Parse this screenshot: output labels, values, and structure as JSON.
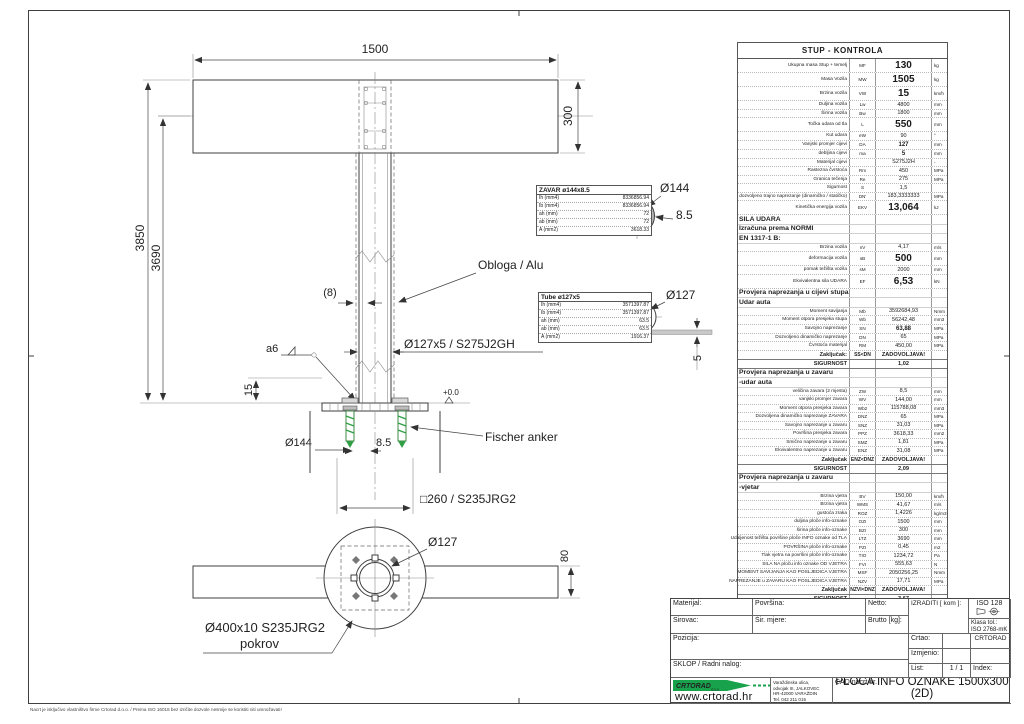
{
  "frame": {
    "disclaimer": "Nacrt  je isključivo vlastništvo firme Crtorad d.o.o. / Prema ISO 16016 bez izričite dozvole nesmije se koristiti niti umnožavati!"
  },
  "drawing": {
    "dim_plate_width": "1500",
    "dim_plate_height": "300",
    "dim_height_total": "3850",
    "dim_height_plate_center": "3690",
    "dim_wall_gap": "(8)",
    "label_cladding": "Obloga / Alu",
    "label_pipe_spec": "Ø127x5 / S275J2GH",
    "label_weld": "a6",
    "dim_plate_offset": "15",
    "dim_level": "+0.0",
    "dim_base_dia": "Ø144",
    "dim_base_weld": "8.5",
    "label_anchor": "Fischer anker",
    "label_base_plate": "□260 / S235JRG2",
    "label_pole_dia_bottom": "Ø127",
    "dim_sign_depth": "80",
    "label_cover_line1": "Ø400x10 S235JRG2",
    "label_cover_line2": "pokrov",
    "detail_weld_dia": "Ø144",
    "detail_weld_size": "8.5",
    "detail_tube_dia": "Ø127",
    "detail_sheet_thickness": "5"
  },
  "zavar_box": {
    "title": "ZAVAR ø144x8.5",
    "rows": [
      [
        "Ih (mm4)",
        "8336856.94"
      ],
      [
        "Ib (mm4)",
        "8336856.94"
      ],
      [
        "ah (mm)",
        "72"
      ],
      [
        "ab (mm)",
        "72"
      ],
      [
        "A (mm2)",
        "3618.33"
      ]
    ]
  },
  "tube_box": {
    "title": "Tube ø127x5",
    "rows": [
      [
        "Ih (mm4)",
        "3571397.87"
      ],
      [
        "Ib (mm4)",
        "3571397.87"
      ],
      [
        "ah (mm)",
        "63.5"
      ],
      [
        "ab (mm)",
        "63.5"
      ],
      [
        "A (mm2)",
        "1916.37"
      ]
    ]
  },
  "kontrola": {
    "title": "STUP - KONTROLA",
    "rows": [
      [
        "Ukupna masa Stup + temelj",
        "MF",
        "130",
        "kg",
        "b"
      ],
      [
        "Masa Vozila",
        "MW",
        "1505",
        "kg",
        "b"
      ],
      [
        "Brzina vozila",
        "VW",
        "15",
        "km/h",
        "b"
      ],
      [
        "Duljina vozila",
        "Lw",
        "4800",
        "mm",
        "n"
      ],
      [
        "Širina vozila",
        "Bw",
        "1800",
        "mm",
        "n"
      ],
      [
        "Točka udara od tla",
        "L",
        "550",
        "mm",
        "b"
      ],
      [
        "Kut udara",
        "eW",
        "90",
        "°",
        "n"
      ],
      [
        "Vanjski promjer cijevi",
        "DA",
        "127",
        "mm",
        "m"
      ],
      [
        "debljina cijevi",
        "ma",
        "5",
        "mm",
        "m"
      ],
      [
        "Materijal cijevi",
        "",
        "S275J2H",
        "-",
        "n"
      ],
      [
        "Rastezna čvrstoća",
        "Rm",
        "450",
        "MPa",
        "n"
      ],
      [
        "Granica tečenja",
        "Re",
        "275",
        "MPa",
        "n"
      ],
      [
        "Sigurnost",
        "S",
        "1,5",
        "",
        "n"
      ],
      [
        "dozvoljeno trajno naprezanje (dinamičko / statičko)",
        "DN'",
        "183,3333333",
        "MPa",
        "n"
      ],
      [
        "Kinetička energija vozila",
        "EKV",
        "13,064",
        "kJ",
        "b"
      ],
      [
        "SILA UDARA",
        "",
        "",
        "",
        "s"
      ],
      [
        "Izračuna prema NORMI",
        "",
        "",
        "",
        "s"
      ],
      [
        "EN 1317-1 B:",
        "",
        "",
        "",
        "s"
      ],
      [
        "Brzina vozila",
        "nV",
        "4,17",
        "m/s",
        "n"
      ],
      [
        "deformacija vozila",
        "sB",
        "500",
        "mm",
        "b"
      ],
      [
        "pomak težišta vozila",
        "sM",
        "2000",
        "mm",
        "n"
      ],
      [
        "Ekvivalentna sila UDARA",
        "EF",
        "6,53",
        "kN",
        "b"
      ],
      [
        "Provjera naprezanja u cijevi stupa",
        "",
        "",
        "",
        "s"
      ],
      [
        "Udar auta",
        "",
        "",
        "",
        "s"
      ],
      [
        "Moment savijanja",
        "Mb",
        "3592684,93",
        "Nmm",
        "n"
      ],
      [
        "Moment otpora presjeka stupa",
        "Wb",
        "56242,48",
        "mm3",
        "n"
      ],
      [
        "Savojno naprezanje",
        "SN",
        "63,88",
        "MPa",
        "m"
      ],
      [
        "Dozvoljeno dinamičko naprezanje",
        "DN",
        "65",
        "MPa",
        "n"
      ],
      [
        "Čvrstoća materijal",
        "RM",
        "450,00",
        "MPa",
        "n"
      ],
      [
        "Zaključak:",
        "SS<DN",
        "ZADOVOLJAVA!",
        "",
        "c"
      ],
      [
        "SIGURNOST",
        "",
        "1,02",
        "",
        "g"
      ],
      [
        "Provjera naprezanja u zavaru",
        "",
        "",
        "",
        "s"
      ],
      [
        "-udar auta",
        "",
        "",
        "",
        "s"
      ],
      [
        "veličina zavara   (2 mjesta)",
        "ZW",
        "8,5",
        "mm",
        "n"
      ],
      [
        "vanjski promjer zavara",
        "WV",
        "144,00",
        "mm",
        "n"
      ],
      [
        "Moment otpora presjeka zavara",
        "Wb2",
        "115788,08",
        "mm3",
        "n"
      ],
      [
        "Dozvoljena dinamičko naprezanje ZAVARA",
        "DNZ",
        "65",
        "MPa",
        "n"
      ],
      [
        "Savojno naprezanje u zavaru",
        "SNZ",
        "31,03",
        "MPa",
        "n"
      ],
      [
        "Površina presjeka zavara",
        "PPZ",
        "3618,33",
        "mm2",
        "n"
      ],
      [
        "Smično naprezanje u zavaru",
        "SMZ",
        "1,81",
        "MPa",
        "n"
      ],
      [
        "Ekvivalentno naprezanje u zavaru",
        "ENZ",
        "31,08",
        "MPa",
        "n"
      ],
      [
        "Zaključak",
        "ENZ<DNZ",
        "ZADOVOLJAVA!",
        "",
        "c"
      ],
      [
        "SIGURNOST",
        "",
        "2,09",
        "",
        "g"
      ],
      [
        "Provjera naprezanja u zavaru",
        "",
        "",
        "",
        "s"
      ],
      [
        "-vjetar",
        "",
        "",
        "",
        "s"
      ],
      [
        "Brzina vjetra",
        "BV",
        "150,00",
        "km/h",
        "n"
      ],
      [
        "Brzina vjetra",
        "WMS",
        "41,67",
        "m/s",
        "n"
      ],
      [
        "gustoća zraka",
        "ROZ",
        "1,4226",
        "kg/m3",
        "n"
      ],
      [
        "duljina ploče info-oznake",
        "OZI",
        "1500",
        "mm",
        "n"
      ],
      [
        "širina ploče info-oznake",
        "BZI",
        "300",
        "mm",
        "n"
      ],
      [
        "Udaljenost težišta površine ploče INFO oznake od TLA",
        "LTZ",
        "3690",
        "mm",
        "n"
      ],
      [
        "POVRŠINA ploče info-oznake",
        "PZI",
        "0,45",
        "m2",
        "n"
      ],
      [
        "Tlak vjetra na površini ploče info-oznake",
        "TIO",
        "1234,72",
        "Pa",
        "n"
      ],
      [
        "SILA NA ploču info oznake OD VJETRA",
        "FVI",
        "555,63",
        "N",
        "n"
      ],
      [
        "MOMENT SAVIJANJA KAO POSLJEDICA VJETRA",
        "MSF",
        "2050256,25",
        "Nmm",
        "n"
      ],
      [
        "NAPREZANJE u ZAVARU KAO POSLJEDICA VJETRA",
        "NZV",
        "17,71",
        "MPa",
        "n"
      ],
      [
        "Zaključak",
        "NZVI<DNZ",
        "ZADOVOLJAVA!",
        "",
        "c"
      ],
      [
        "SIGURNOST",
        "",
        "3,67",
        "",
        "g"
      ]
    ]
  },
  "title_block": {
    "materijal_label": "Materijal:",
    "povrsina_label": "Površina:",
    "netto_label": "Netto:",
    "izraditi_label": "IZRADITI [ kom ]:",
    "iso_label": "ISO 128",
    "sirovac_label": "Sirovac:",
    "sir_mjere_label": "Šir. mjere:",
    "brutto_label": "Brutto [kg]:",
    "klasa_label": "Klasa tol.:",
    "klasa_value": "ISO 2768-mK",
    "pozicija_label": "Pozicija:",
    "sklop_label": "SKLOP / Radni nalog:",
    "crtao_label": "Crtao:",
    "crtao_value": "CRTORAD",
    "izmjenio_label": "Izmjenio:",
    "list_label": "List:",
    "list_value": "1  /  1",
    "index_label": "Index:",
    "cad_label": "CAD nacrt br.",
    "drawing_title": "PLOČA INFO OZNAKE 1500x300  (2D)"
  },
  "company": {
    "name": "CRTORAD",
    "suffix": "d.o.o.",
    "website": "www.crtorad.hr",
    "address_lines": [
      "Varaždinska ulica,",
      "odvojak III, JALKOVEC",
      "HR-42000 VARAŽDIN",
      "Tel. 042 211 015"
    ]
  }
}
